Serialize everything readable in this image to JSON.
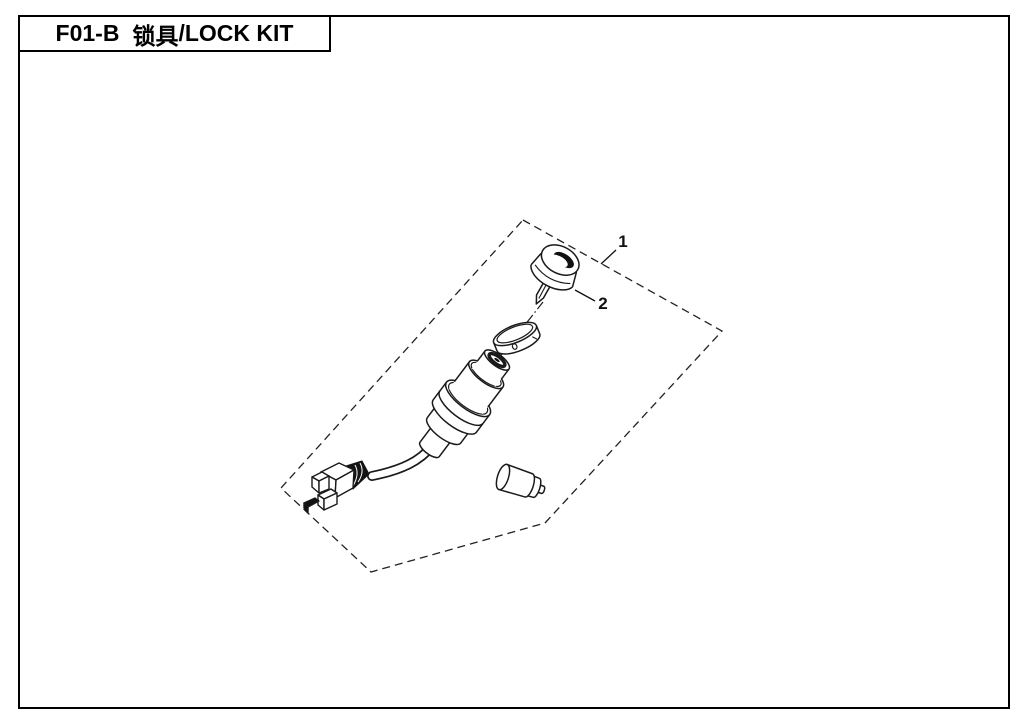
{
  "window": {
    "width": 1025,
    "height": 724,
    "background": "#ffffff",
    "line_color": "#1a1a1a"
  },
  "header": {
    "code": "F01-B",
    "name_cn": "锁具",
    "separator": "/",
    "name_en": "LOCK KIT",
    "full_title": "F01-B 锁具/LOCK KIT"
  },
  "diagram": {
    "callouts": [
      {
        "label": "1",
        "points_to": "lock-kit-assembly-boundary"
      },
      {
        "label": "2",
        "points_to": "ignition-key-knob"
      }
    ]
  }
}
